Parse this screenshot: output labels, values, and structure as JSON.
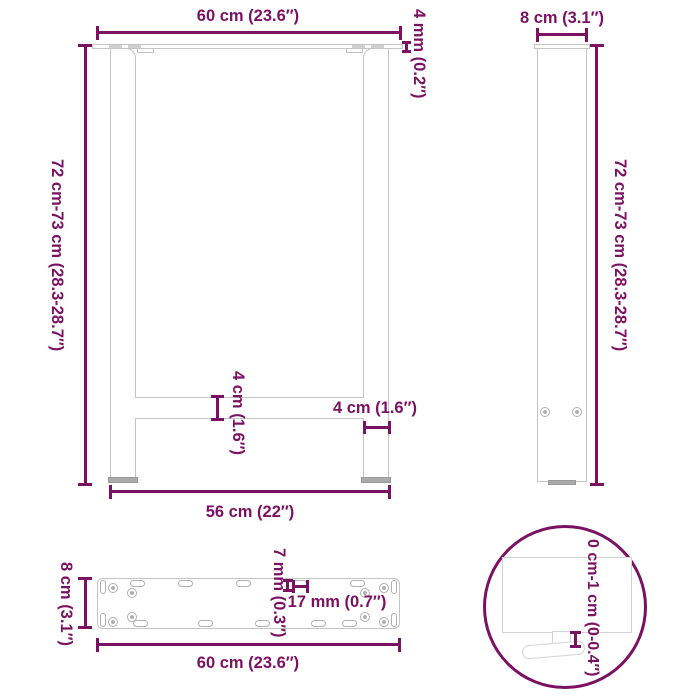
{
  "diagram": {
    "accent_color": "#7a1163",
    "outline_color": "#c4c4c4",
    "front_view": {
      "top_width": "60 cm (23.6″)",
      "plate_thickness": "4 mm (0.2″)",
      "height_range": "72 cm-73 cm (28.3-28.7″)",
      "crossbar_thickness": "4 cm (1.6″)",
      "leg_width": "4 cm (1.6″)",
      "bottom_span": "56 cm (22″)"
    },
    "side_view": {
      "width": "8 cm (3.1″)",
      "height_range": "72 cm-73 cm (28.3-28.7″)"
    },
    "plate_view": {
      "depth": "8 cm (3.1″)",
      "slot_width": "7 mm (0.3″)",
      "slot_length": "17 mm (0.7″)",
      "length": "60 cm (23.6″)"
    },
    "foot_detail": {
      "adjustable_range": "0 cm-1 cm (0-0.4″)"
    }
  }
}
